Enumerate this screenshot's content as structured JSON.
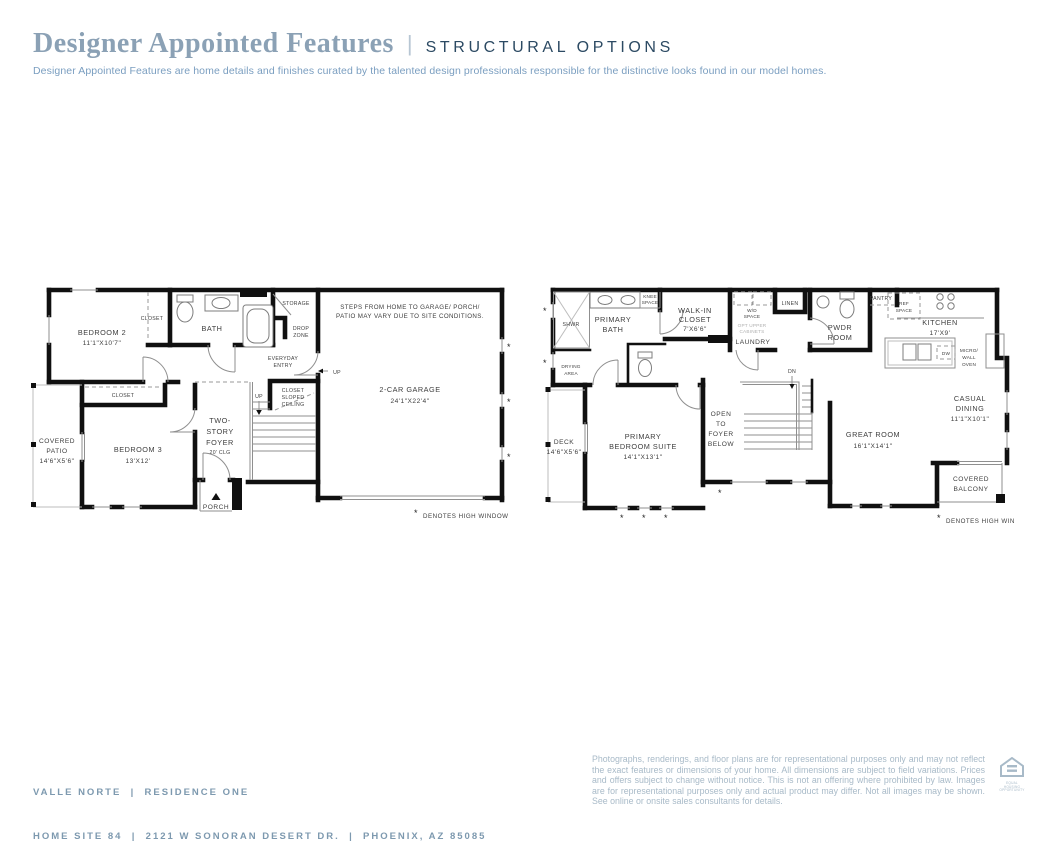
{
  "header": {
    "title": "Designer Appointed Features",
    "sep": "|",
    "caps": "STRUCTURAL OPTIONS",
    "description": "Designer Appointed Features are home details and finishes curated by the talented design professionals responsible for the distinctive looks found in our model homes."
  },
  "f1": {
    "bedroom2": [
      "BEDROOM 2",
      "11'1\"X10'7\""
    ],
    "closet_top": "CLOSET",
    "bath": "BATH",
    "storage": "STORAGE",
    "drop_zone": [
      "DROP",
      "ZONE"
    ],
    "everyday_entry": [
      "EVERYDAY",
      "ENTRY"
    ],
    "up_from_garage": "UP",
    "note": [
      "STEPS FROM HOME TO GARAGE/ PORCH/",
      "PATIO MAY VARY DUE TO SITE CONDITIONS."
    ],
    "garage": [
      "2-CAR GARAGE",
      "24'1\"X22'4\""
    ],
    "closet_mid": "CLOSET",
    "patio": [
      "COVERED",
      "PATIO",
      "14'6\"X5'6\""
    ],
    "bedroom3": [
      "BEDROOM 3",
      "13'X12'"
    ],
    "foyer": [
      "TWO-",
      "STORY",
      "FOYER",
      "20' CLG"
    ],
    "up_stairs": "UP",
    "closet_sloped": [
      "CLOSET",
      "SLOPED",
      "CEILING"
    ],
    "porch": "PORCH",
    "star": "*",
    "legend_text": "DENOTES HIGH WINDOW"
  },
  "f2": {
    "shwr": "SHWR",
    "drying": [
      "DRYING",
      "AREA"
    ],
    "primary_bath": [
      "PRIMARY",
      "BATH"
    ],
    "knee": [
      "KNEE",
      "SPACE"
    ],
    "wic": [
      "WALK-IN",
      "CLOSET",
      "7'X6'6\""
    ],
    "wd": [
      "W/D",
      "SPACE"
    ],
    "opt_upper": [
      "OPT UPPER",
      "CABINETS"
    ],
    "laundry": "LAUNDRY",
    "linen": "LINEN",
    "pwdr": [
      "PWDR",
      "ROOM"
    ],
    "pantry": "PANTRY",
    "ref": [
      "REF",
      "SPACE"
    ],
    "kitchen": [
      "KITCHEN",
      "17'X9'"
    ],
    "dw": "DW",
    "micro": [
      "MICRO/",
      "WALL",
      "OVEN"
    ],
    "dn": "DN",
    "open_foyer": [
      "OPEN",
      "TO",
      "FOYER",
      "BELOW"
    ],
    "deck": [
      "DECK",
      "14'6\"X5'6\""
    ],
    "suite": [
      "PRIMARY",
      "BEDROOM SUITE",
      "14'1\"X13'1\""
    ],
    "great": [
      "GREAT ROOM",
      "16'1\"X14'1\""
    ],
    "dining": [
      "CASUAL",
      "DINING",
      "11'1\"X10'1\""
    ],
    "balcony": [
      "COVERED",
      "BALCONY"
    ],
    "star": "*",
    "legend_text": "DENOTES HIGH WINDOW"
  },
  "footer": {
    "line1": "VALLE NORTE  |  RESIDENCE ONE",
    "line2": "HOME SITE 84  |  2121 W SONORAN DESERT DR.  |  PHOENIX, AZ 85085",
    "disclaimer": "Photographs, renderings, and floor plans are for representational purposes only and may not reflect the exact features or dimensions of your home. All dimensions are subject to field variations. Prices and offers subject to change without notice. This is not an offering where prohibited by law. Images are for representational purposes only and actual product may differ. Not all images may be shown. See online or onsite sales consultants for details.",
    "equal_housing": [
      "EQUAL HOUSING",
      "OPPORTUNITY"
    ]
  },
  "colors": {
    "title": "#8ba1b5",
    "caps": "#2c4a63",
    "description": "#7a9ec0",
    "footer_text": "#7d99af",
    "disclaimer_text": "#a8bac8",
    "walls": "#101010",
    "plan_text": "#3e3e3e"
  }
}
